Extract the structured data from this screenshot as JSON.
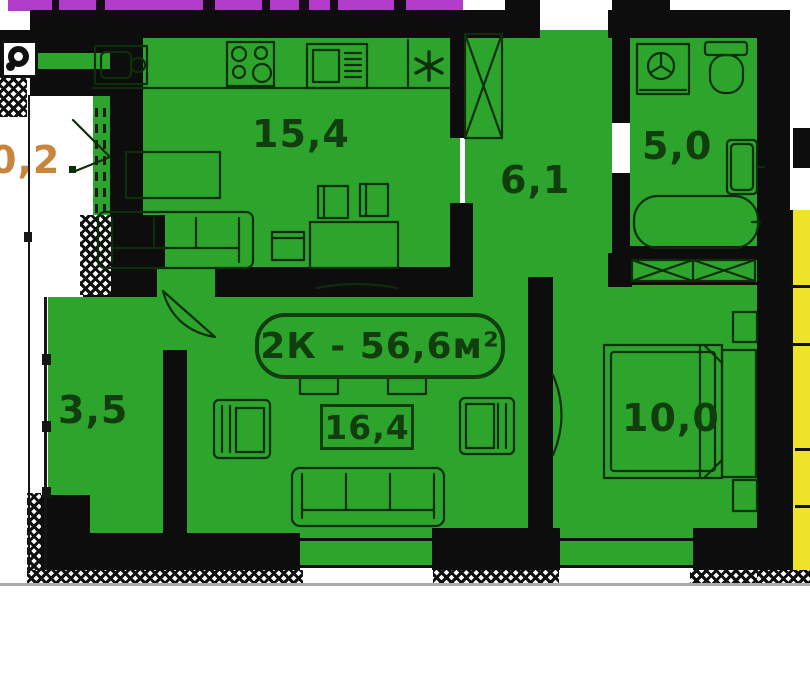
{
  "plan": {
    "title": "2К - 56,6м²",
    "rooms": [
      {
        "key": "kitchen-living",
        "area": "15,4"
      },
      {
        "key": "hallway",
        "area": "6,1"
      },
      {
        "key": "bathroom",
        "area": "5,0"
      },
      {
        "key": "storage-room",
        "area": "3,5"
      },
      {
        "key": "living-room",
        "area": "16,4"
      },
      {
        "key": "bedroom",
        "area": "10,0"
      },
      {
        "key": "balcony",
        "area": "0,2"
      }
    ]
  },
  "icons": {
    "fridge-icon": "✳",
    "vent-icon": "◎",
    "sink-icon": "kitchen sink",
    "stove-icon": "4-burner stove",
    "oven-icon": "oven with vents",
    "wardrobe-icon": "X-crossed wardrobe",
    "washing-machine-icon": "drum circle with 3 spokes",
    "toilet-icon": "tank + bowl",
    "washbasin-icon": "wall basin",
    "bathtub-icon": "rounded tub",
    "built-in-wardrobe-icon": "X-crossed shelf strip",
    "bed-icon": "double bed with headboard",
    "sofa-icon": "3-seat sofa",
    "armchair-icon": "armchair",
    "table-icon": "table",
    "chair-icon": "chair",
    "nightstand-icon": "nightstand",
    "tv-icon": "curved tv line",
    "door-arc-icon": "door swing"
  },
  "colors": {
    "room-fill": "#2da42c",
    "wall": "#0d0d0d",
    "strip-purple": "#b13cc9",
    "neighbor-yellow": "#efe32a",
    "balcony-label": "#c8863c",
    "room-label": "#123d0e",
    "furniture-line": "#0c2f0a",
    "baseline": "#ababab"
  }
}
